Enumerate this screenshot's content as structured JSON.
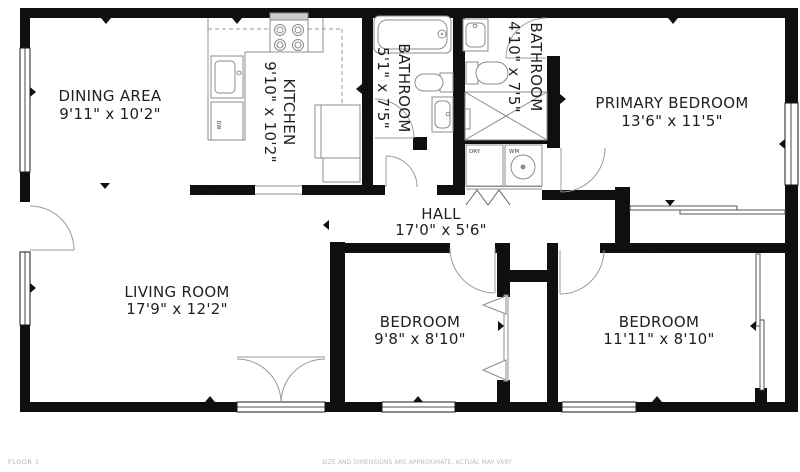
{
  "title": "Floor plan",
  "footer": {
    "left": "FLOOR 1",
    "right": "SIZE AND DIMENSIONS ARE APPROXIMATE, ACTUAL MAY VARY"
  },
  "rooms": {
    "dining": {
      "name": "DINING AREA",
      "dims": "9'11\" x 10'2\""
    },
    "kitchen": {
      "name": "KITCHEN",
      "dims": "9'10\" x 10'2\""
    },
    "bathroom1": {
      "name": "BATHROOM",
      "dims": "5'1\" x 7'5\""
    },
    "bathroom2": {
      "name": "BATHROOM",
      "dims": "4'10\" x 7'5\""
    },
    "primary_bedroom": {
      "name": "PRIMARY BEDROOM",
      "dims": "13'6\" x 11'5\""
    },
    "hall": {
      "name": "HALL",
      "dims": "17'0\" x 5'6\""
    },
    "living": {
      "name": "LIVING ROOM",
      "dims": "17'9\" x 12'2\""
    },
    "bedroom1": {
      "name": "BEDROOM",
      "dims": "9'8\" x 8'10\""
    },
    "bedroom2": {
      "name": "BEDROOM",
      "dims": "11'11\" x 8'10\""
    }
  },
  "appliances": {
    "dishwasher": "DW",
    "dryer": "DRY",
    "washer": "WM"
  },
  "colors": {
    "wall": "#0f0f0f",
    "fixture_line": "#8c8c8c",
    "door_arc": "#9a9a9a",
    "label_text": "#1f1f1f",
    "footer_text": "#b3b3b3",
    "stove_top": "#cccccc"
  }
}
